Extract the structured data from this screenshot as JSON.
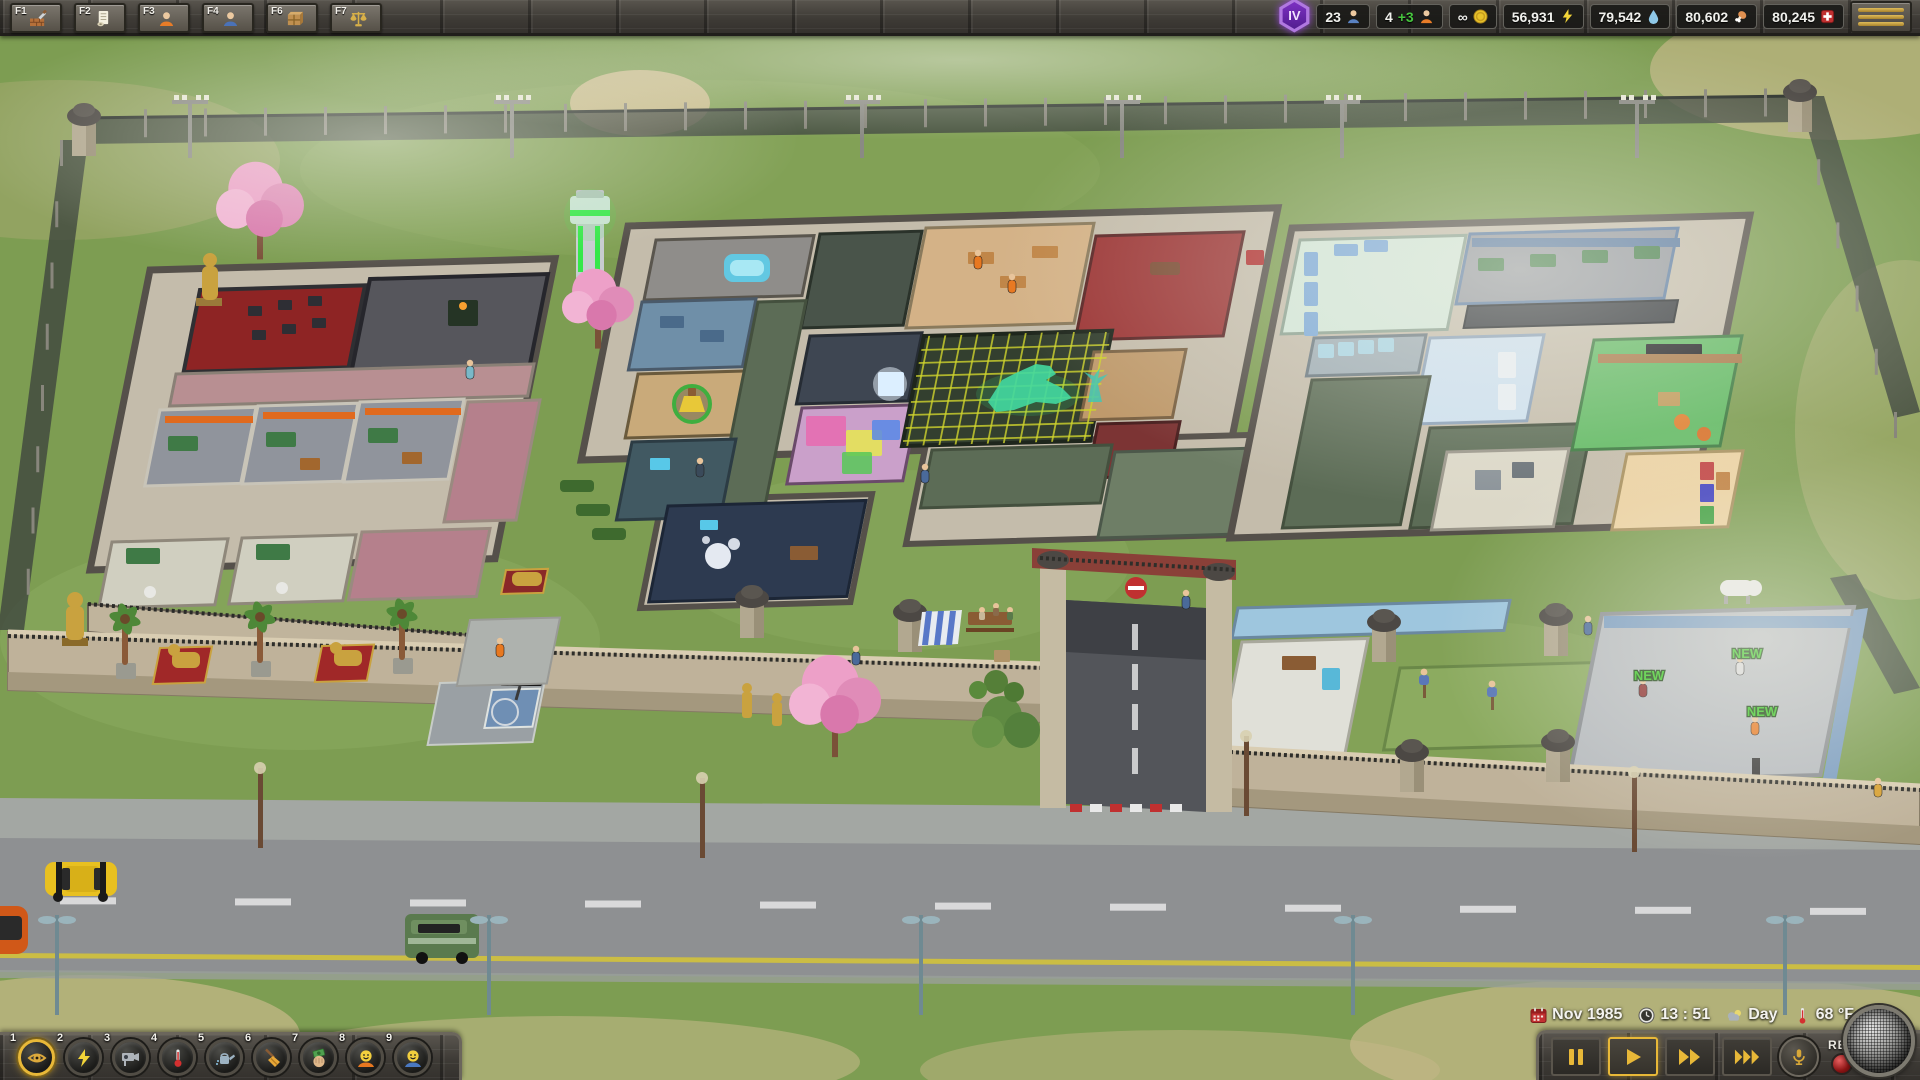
{
  "top_bar": {
    "hotkeys": [
      {
        "key": "F1",
        "icon": "build-icon"
      },
      {
        "key": "F2",
        "icon": "contracts-icon"
      },
      {
        "key": "F3",
        "icon": "prisoners-icon"
      },
      {
        "key": "F4",
        "icon": "staff-icon"
      },
      {
        "key": "F6",
        "icon": "objects-icon"
      },
      {
        "key": "F7",
        "icon": "policy-icon"
      }
    ],
    "level_badge": "IV",
    "stats": {
      "staff_count": "23",
      "prisoner_count": "4",
      "prisoner_incoming": "+3",
      "money": "∞",
      "power": "56,931",
      "water": "79,542",
      "food": "80,602",
      "medical": "80,245"
    }
  },
  "overlay_toolbar": {
    "items": [
      {
        "num": "1",
        "name": "overview",
        "selected": true
      },
      {
        "num": "2",
        "name": "power"
      },
      {
        "num": "3",
        "name": "security-camera"
      },
      {
        "num": "4",
        "name": "temperature"
      },
      {
        "num": "5",
        "name": "watering"
      },
      {
        "num": "6",
        "name": "cleaning"
      },
      {
        "num": "7",
        "name": "cash"
      },
      {
        "num": "8",
        "name": "prisoner-mood"
      },
      {
        "num": "9",
        "name": "staff-mood"
      }
    ]
  },
  "status_bar": {
    "date": "Nov 1985",
    "time": "13 : 51",
    "day_phase": "Day",
    "temperature": "68 °F"
  },
  "playback": {
    "rec_label": "REC",
    "selected_speed": "play"
  },
  "scene": {
    "new_labels": [
      "NEW",
      "NEW",
      "NEW"
    ]
  },
  "colors": {
    "accent_gold": "#e8b838",
    "incoming_green": "#46c43e",
    "power_yellow": "#f2d438",
    "water_blue": "#8ec8e8",
    "food_orange": "#e09050",
    "medical_red": "#c03030",
    "badge_purple": "#7b2fbe",
    "new_label_green": "#35c81e"
  }
}
